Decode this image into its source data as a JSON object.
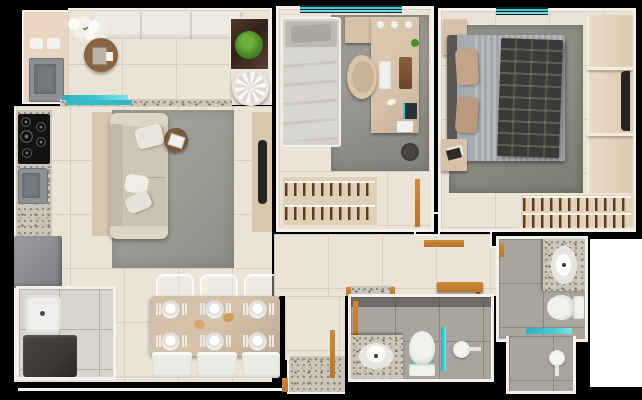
{
  "scene": {
    "type": "apartment-floor-plan-3d-render",
    "background": "#000000",
    "width_px": 642,
    "height_px": 400
  },
  "palette": {
    "bg_black": "#000000",
    "wall_white": "#f4f1ec",
    "floor_beige": "#ebe3d6",
    "grout_beige": "#d8cfc0",
    "wall_beige": "#e9d5c2",
    "tile_bath": "#a9a59e",
    "grout_bath": "#8c8880",
    "tile_service": "#d8d5cf",
    "grout_service": "#b4b0aa",
    "granite_base": "#ccc6ba",
    "wood": "#b9752e",
    "teal": "#3fc6d2",
    "sofa": "#cfc7b8",
    "panel_beige": "#d9c6af",
    "rug_gray": "#9b9a93",
    "rug_dark": "#8b8d84",
    "furn_beige": "#d6c2aa",
    "appliance_gray": "#8e9194",
    "appliance_dark": "#3e3936",
    "tv_dark": "#262524",
    "bed_light": "#d4d2cc",
    "duvet_stripe": "#aeb2b7",
    "plaid_dark": "#3a3a38",
    "pillow_tan": "#c3a488",
    "white_fixture": "#f2f1ed",
    "plant_green": "#4e8f2c",
    "table_wood": "#6e4b31"
  },
  "layout": {
    "bedrooms": 2,
    "bathrooms": 2,
    "rooms": [
      {
        "id": "balcony",
        "items": [
          "bench-sofa",
          "flower-bouquet",
          "round-tray-table",
          "plant-stand",
          "round-side-table",
          "grill-counter-sink",
          "granite-ledge",
          "sliding-glass-door"
        ]
      },
      {
        "id": "kitchen",
        "cooktop_burners": 5,
        "items": [
          "granite-counter",
          "cooktop",
          "kitchen-sink",
          "refrigerator"
        ]
      },
      {
        "id": "living-room",
        "items": [
          "sofa",
          "throw-pillows",
          "area-rug",
          "round-side-table",
          "tv-panel",
          "tv"
        ]
      },
      {
        "id": "dining-area",
        "place_settings": 6,
        "chairs": 6,
        "items": [
          "dining-table",
          "plates",
          "clear-chairs",
          "white-chairs",
          "bread"
        ]
      },
      {
        "id": "laundry-area",
        "items": [
          "wash-tank",
          "washing-machine"
        ]
      },
      {
        "id": "bedroom-1",
        "items": [
          "single-bed",
          "desk",
          "desk-chair",
          "keyboard",
          "rug",
          "wardrobe-hanger-rail",
          "waste-bin",
          "window",
          "wooden-door"
        ]
      },
      {
        "id": "bedroom-2",
        "items": [
          "double-bed",
          "plaid-blanket",
          "pillows",
          "nightstand",
          "rug",
          "closet-shelving",
          "tv",
          "hanger-rails",
          "window"
        ]
      },
      {
        "id": "hallway",
        "items": [
          "wall-console",
          "wall-shelf",
          "wooden-door-frames"
        ]
      },
      {
        "id": "bathroom-1",
        "items": [
          "granite-vanity",
          "oval-sink",
          "toilet",
          "glass-shower-screen",
          "shower-head",
          "wooden-door"
        ]
      },
      {
        "id": "bathroom-2",
        "items": [
          "granite-vanity",
          "oval-sink",
          "toilet",
          "glass-shelf",
          "shower-head",
          "wooden-door-frame"
        ]
      }
    ]
  }
}
